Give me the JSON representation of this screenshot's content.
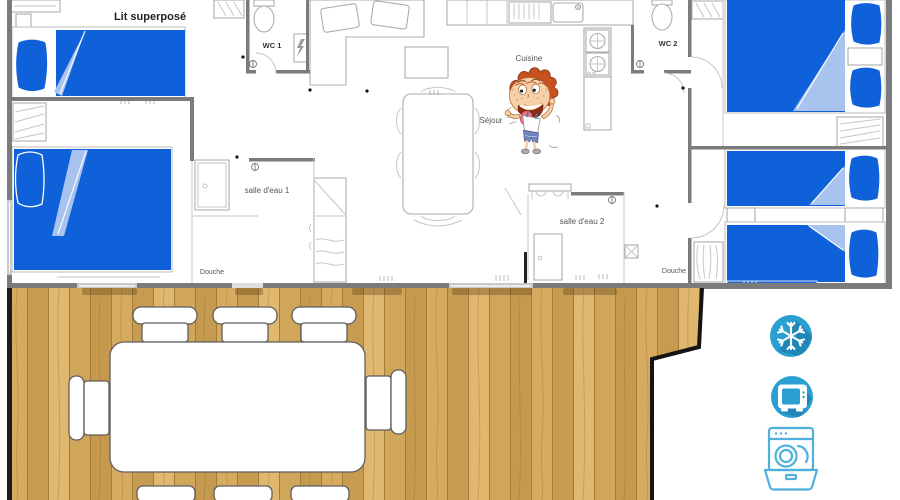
{
  "plan": {
    "labels": {
      "bunk_bed": "Lit superposé",
      "wc1": "WC 1",
      "wc2": "WC 2",
      "kitchen": "Cuisine",
      "living_room": "Séjour",
      "bathroom1": "salle d'eau 1",
      "bathroom2": "salle d'eau 2",
      "shower1": "Douche",
      "shower2": "Douche"
    },
    "colors": {
      "bed_blue": "#0e61d8",
      "bed_fold_blue": "#a9c3ef",
      "wall_gray": "#7b7b7b",
      "furniture_outline": "#adadad",
      "window_blue": "#2066d2"
    }
  },
  "terrace": {
    "colors": {
      "wood_light": "#e0b76e",
      "wood_mid": "#d7ab5f",
      "wood_dark": "#c89c50",
      "edge_black": "#161616"
    },
    "table_count": 1,
    "chair_count": 8
  },
  "amenities": {
    "icon_color": "#2aa0d2",
    "icon_shadow_color": "#1f86b6",
    "outline_icon_color": "#4fb0de",
    "items": [
      {
        "name": "air-conditioning",
        "icon": "snowflake-icon"
      },
      {
        "name": "television",
        "icon": "tv-icon"
      },
      {
        "name": "dishwasher",
        "icon": "dishwasher-icon"
      }
    ]
  }
}
